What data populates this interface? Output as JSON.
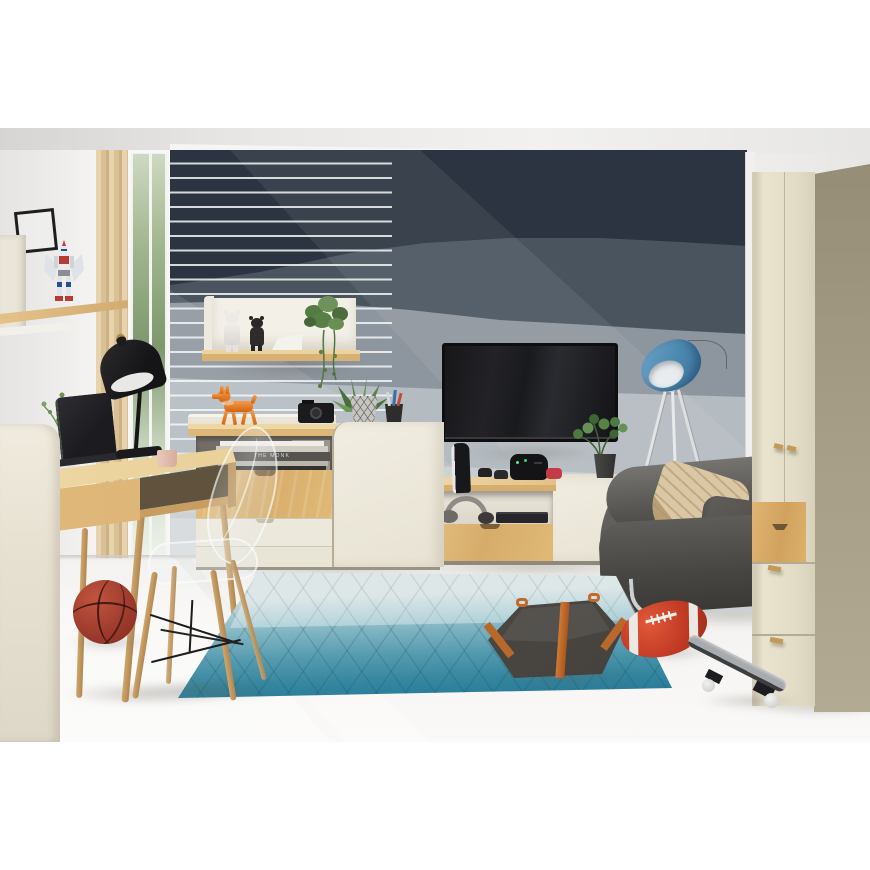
{
  "meta": {
    "description": "Product photograph of a youth room furniture set: oak and cream desk, sideboard, TV stand and wardrobe against a navy layered mural wall, with a grey sofa, blue tripod lamp, teal diamond rug, transparent chair and sports props.",
    "image_type": "furniture showroom photo"
  },
  "visible_text": {
    "book_spine": "THE MONK"
  },
  "palette": {
    "mural_navy": "#2b3440",
    "mural_slate": "#4a545f",
    "mural_gray_blue": "#8d959e",
    "mural_pale": "#b4bbc1",
    "oak_wood": "#d6ac6a",
    "cream_furniture": "#e7e2d3",
    "wardrobe_side": "#a49b85",
    "sofa_gray": "#514f4b",
    "rug_teal": "#2e819c",
    "lamp_blue": "#5b94ba",
    "figurine_orange": "#e8823a",
    "football_red": "#c13a24",
    "basketball_red_brown": "#9c3a2c",
    "curtain_beige": "#d9c195"
  },
  "objects": [
    {
      "id": "wall-mural",
      "label": "navy layered wall mural"
    },
    {
      "id": "slat-wall",
      "label": "striped slat wall panel"
    },
    {
      "id": "window",
      "label": "window with greenery outside"
    },
    {
      "id": "curtain",
      "label": "beige curtain"
    },
    {
      "id": "wall-shelf-left",
      "label": "oak wall shelf with robot model"
    },
    {
      "id": "gundam-figure",
      "label": "robot model figure"
    },
    {
      "id": "picture-frame",
      "label": "black picture frame"
    },
    {
      "id": "wall-shelf-center",
      "label": "cream and oak wall shelf"
    },
    {
      "id": "bearbrick-white",
      "label": "white bear figure"
    },
    {
      "id": "bearbrick-black",
      "label": "black bear figure"
    },
    {
      "id": "hanging-plant",
      "label": "trailing plant"
    },
    {
      "id": "desk",
      "label": "oak writing desk"
    },
    {
      "id": "desk-lamp",
      "label": "black desk lamp"
    },
    {
      "id": "laptop",
      "label": "laptop"
    },
    {
      "id": "mug",
      "label": "mug"
    },
    {
      "id": "ghost-chair",
      "label": "transparent chair with wood legs"
    },
    {
      "id": "basketball",
      "label": "basketball"
    },
    {
      "id": "sideboard",
      "label": "oak and cream sideboard"
    },
    {
      "id": "dog-figurine",
      "label": "orange puppy figurine"
    },
    {
      "id": "camera",
      "label": "black camera"
    },
    {
      "id": "basket-plant",
      "label": "potted plant in wire basket"
    },
    {
      "id": "pencil-cup",
      "label": "wire pencil cup"
    },
    {
      "id": "books",
      "label": "stack of books"
    },
    {
      "id": "tv",
      "label": "wall mounted TV"
    },
    {
      "id": "tv-stand",
      "label": "oak and cream TV stand"
    },
    {
      "id": "game-console",
      "label": "white-black game console"
    },
    {
      "id": "vr-headset",
      "label": "VR headset"
    },
    {
      "id": "headphones",
      "label": "headphones"
    },
    {
      "id": "media-player",
      "label": "media player"
    },
    {
      "id": "floor-lamp",
      "label": "blue tripod floor lamp"
    },
    {
      "id": "sofa",
      "label": "grey sofa"
    },
    {
      "id": "pillow-beige",
      "label": "patterned beige pillow"
    },
    {
      "id": "pillow-gray",
      "label": "grey pillow"
    },
    {
      "id": "pouf",
      "label": "grey faceted pouf with orange straps"
    },
    {
      "id": "rug",
      "label": "teal gradient diamond rug"
    },
    {
      "id": "football",
      "label": "red american football"
    },
    {
      "id": "skateboard",
      "label": "skateboard"
    },
    {
      "id": "wardrobe",
      "label": "cream wardrobe with oak drawer"
    }
  ]
}
